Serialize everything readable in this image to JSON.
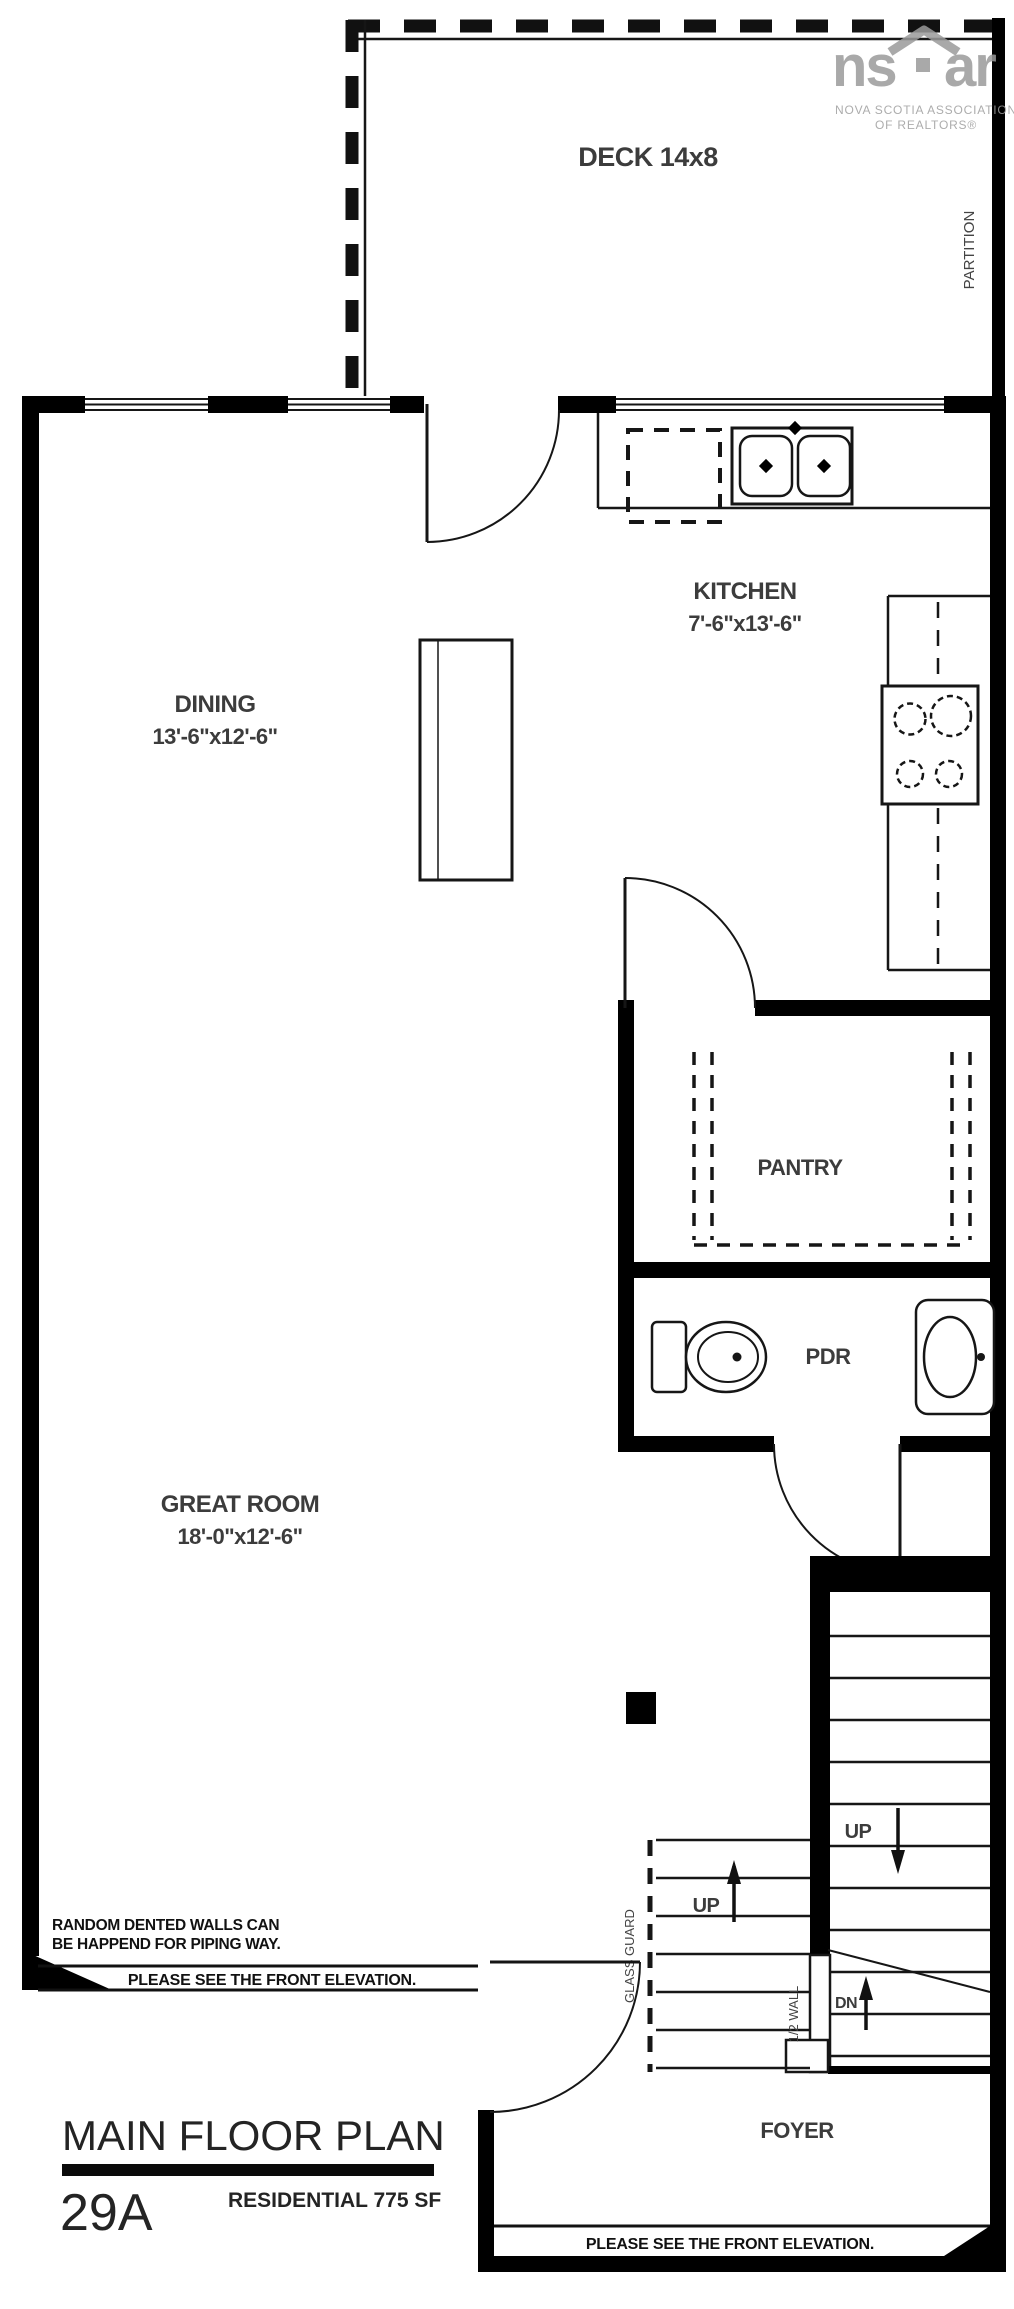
{
  "logo": {
    "brand_left": "ns",
    "brand_right": "ar",
    "tagline_1": "NOVA SCOTIA ASSOCIATION",
    "tagline_2": "OF REALTORS®"
  },
  "rooms": {
    "deck": {
      "label": "DECK 14x8"
    },
    "kitchen": {
      "label": "KITCHEN",
      "dims": "7'-6\"x13'-6\""
    },
    "dining": {
      "label": "DINING",
      "dims": "13'-6\"x12'-6\""
    },
    "pantry": {
      "label": "PANTRY"
    },
    "pdr": {
      "label": "PDR"
    },
    "great_room": {
      "label": "GREAT ROOM",
      "dims": "18'-0\"x12'-6\""
    },
    "foyer": {
      "label": "FOYER"
    }
  },
  "stairs": {
    "up_right": "UP",
    "up_left": "UP",
    "down": "DN",
    "glass_guard": "GLASS GUARD",
    "half_wall": "1/2 WALL"
  },
  "annotations": {
    "partition": "PARTITION",
    "piping_note_line1": "RANDOM DENTED WALLS CAN",
    "piping_note_line2": "BE HAPPEND FOR PIPING WAY.",
    "front_elevation_note_left": "PLEASE SEE THE FRONT ELEVATION.",
    "front_elevation_note_bottom": "PLEASE SEE THE FRONT ELEVATION."
  },
  "title_block": {
    "title": "MAIN FLOOR PLAN",
    "unit_number": "29A",
    "subtitle": "RESIDENTIAL 775 SF"
  },
  "colors": {
    "wall": "#000000",
    "label_text": "#3c3c3c",
    "logo_gray": "#9b9b9b"
  }
}
